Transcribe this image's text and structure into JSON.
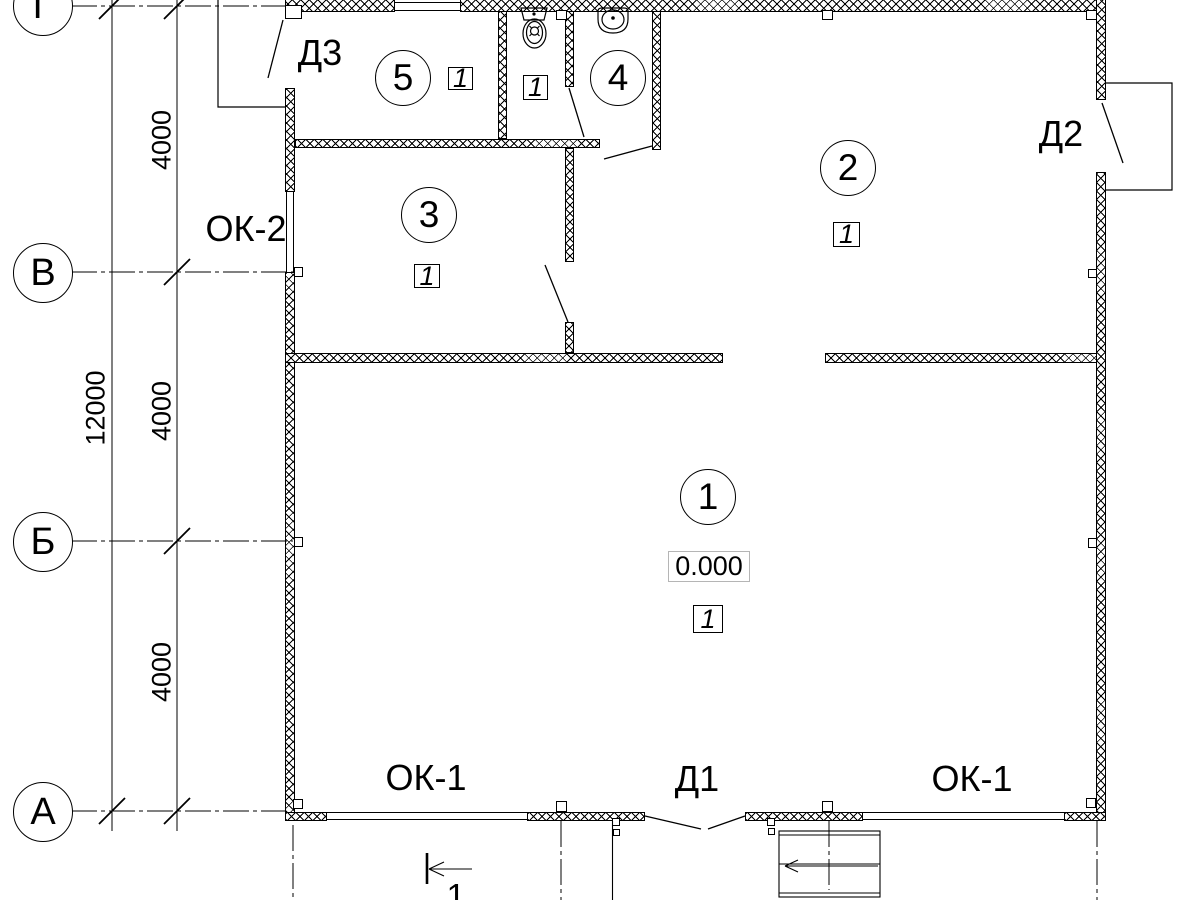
{
  "axes": {
    "row_labels": [
      "Г",
      "В",
      "Б",
      "А"
    ]
  },
  "dimensions": {
    "total": "12000",
    "segments": [
      "4000",
      "4000",
      "4000"
    ]
  },
  "doors": {
    "d3": "Д3",
    "d2": "Д2",
    "d1": "Д1"
  },
  "windows": {
    "ok2": "ОК-2",
    "ok1_left": "ОК-1",
    "ok1_right": "ОК-1"
  },
  "rooms": {
    "r1": {
      "num": "1",
      "finish": "1",
      "level": "0.000"
    },
    "r2": {
      "num": "2",
      "finish": "1"
    },
    "r3": {
      "num": "3",
      "finish": "1"
    },
    "r4": {
      "num": "4"
    },
    "r5": {
      "num": "5",
      "finish": "1"
    },
    "wc": {
      "finish": "1"
    }
  },
  "section": {
    "num": "1"
  }
}
